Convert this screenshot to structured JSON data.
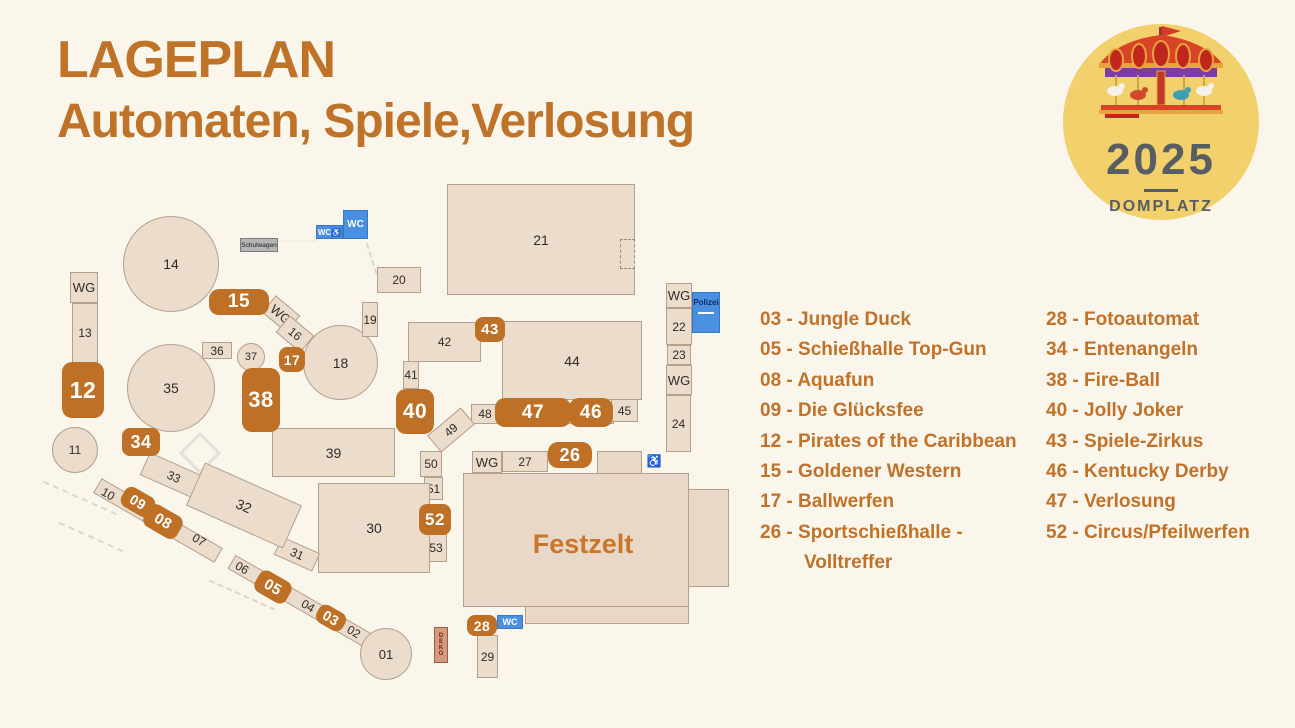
{
  "title": {
    "line1": "LAGEPLAN",
    "line2": "Automaten, Spiele,Verlosung"
  },
  "logo": {
    "year": "2025",
    "venue": "DOMPLATZ",
    "icon": "carousel-icon"
  },
  "legend": {
    "left": [
      "03 - Jungle Duck",
      "05 - Schießhalle Top-Gun",
      "08 - Aquafun",
      "09 - Die Glücksfee",
      "12 - Pirates of the Caribbean",
      "15 - Goldener Western",
      "17 - Ballwerfen",
      "26 - Sportschießhalle -",
      "Volltreffer"
    ],
    "right": [
      "28 - Fotoautomat",
      "34 - Entenangeln",
      "38 - Fire-Ball",
      "40 - Jolly Joker",
      "43 - Spiele-Zirkus",
      "46 - Kentucky Derby",
      "47 - Verlosung",
      "52 - Circus/Pfeilwerfen"
    ]
  },
  "map": {
    "labels": {
      "01": "01",
      "02": "02",
      "03": "03",
      "04": "04",
      "05": "05",
      "06": "06",
      "07": "07",
      "08": "08",
      "09": "09",
      "10": "10",
      "11": "11",
      "12": "12",
      "13": "13",
      "14": "14",
      "15": "15",
      "16": "16",
      "17": "17",
      "18": "18",
      "19": "19",
      "20": "20",
      "21": "21",
      "22": "22",
      "23": "23",
      "24": "24",
      "26": "26",
      "27": "27",
      "28": "28",
      "29": "29",
      "30": "30",
      "31": "31",
      "32": "32",
      "33": "33",
      "34": "34",
      "35": "35",
      "36": "36",
      "37": "37",
      "38": "38",
      "39": "39",
      "40": "40",
      "41": "41",
      "42": "42",
      "43": "43",
      "44": "44",
      "45": "45",
      "46": "46",
      "47": "47",
      "48": "48",
      "49": "49",
      "50": "50",
      "51": "51",
      "52": "52",
      "53": "53",
      "wg": "WG",
      "wc": "WC",
      "wc_accessible": "WC♿",
      "accessible": "♿",
      "schulwagen": "Schulwagen",
      "polizei": "Polizei",
      "deko": "DEKO",
      "festzelt": "Festzelt"
    },
    "highlighted_stalls": [
      "03",
      "05",
      "08",
      "09",
      "12",
      "15",
      "17",
      "26",
      "28",
      "34",
      "38",
      "40",
      "43",
      "46",
      "47",
      "52"
    ]
  },
  "colors": {
    "background": "#fbf6ec",
    "accent_text": "#bf7329",
    "marker_orange": "#bd7026",
    "building_fill": "#ecdccb",
    "building_border": "#b3a18e",
    "info_blue": "#4a90e2",
    "logo_yellow": "#f2d06b",
    "logo_text": "#585d61",
    "festzelt_label": "#c8762b"
  }
}
